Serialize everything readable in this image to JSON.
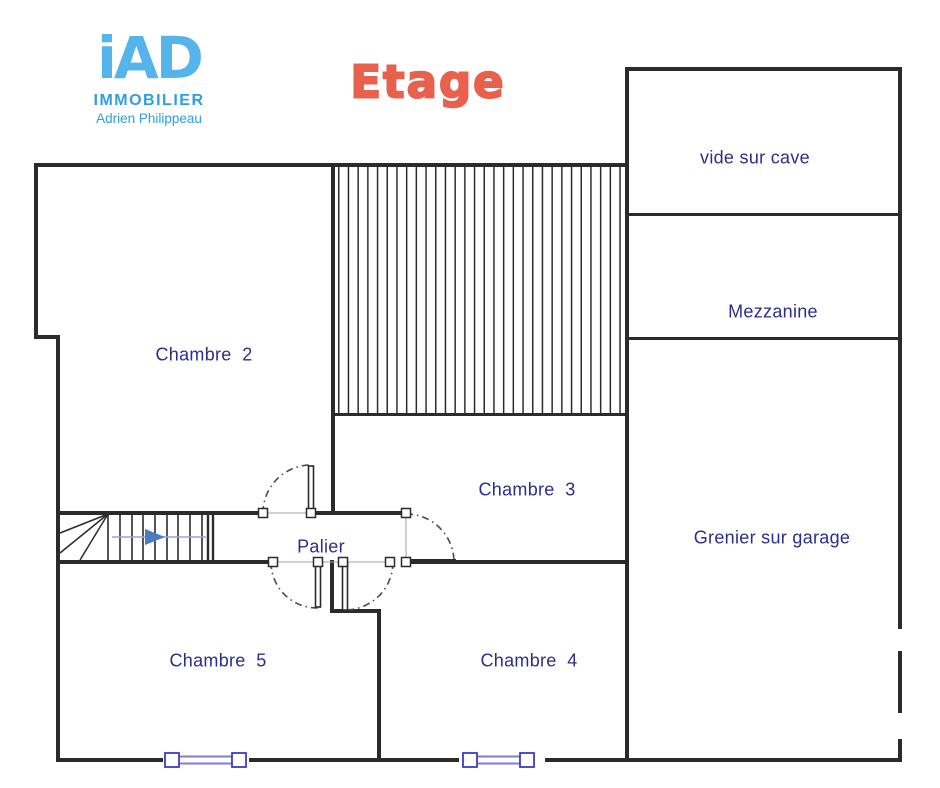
{
  "branding": {
    "logo_text": "iAD",
    "logo_subtitle": "IMMOBILIER",
    "agent_name": "Adrien Philippeau"
  },
  "title": "Etage",
  "rooms": {
    "chambre2": {
      "label": "Chambre  2"
    },
    "chambre3": {
      "label": "Chambre  3"
    },
    "chambre4": {
      "label": "Chambre  4"
    },
    "chambre5": {
      "label": "Chambre  5"
    },
    "palier": {
      "label": "Palier"
    },
    "vide_sur_cave": {
      "label": "vide sur cave"
    },
    "mezzanine": {
      "label": "Mezzanine"
    },
    "grenier": {
      "label": "Grenier sur garage"
    }
  },
  "colors": {
    "wall": "#2b2b2b",
    "room_label": "#2d2d8f",
    "logo_blue": "#55b4ea",
    "logo_sub_blue": "#2f9fe2",
    "title_coral": "#e8614d",
    "window_blue": "#3c3cc8",
    "window_line_blue": "#7d7dd2",
    "stair_arrow_line": "#8fa9d6",
    "stair_arrow_head": "#4a7cc0"
  }
}
